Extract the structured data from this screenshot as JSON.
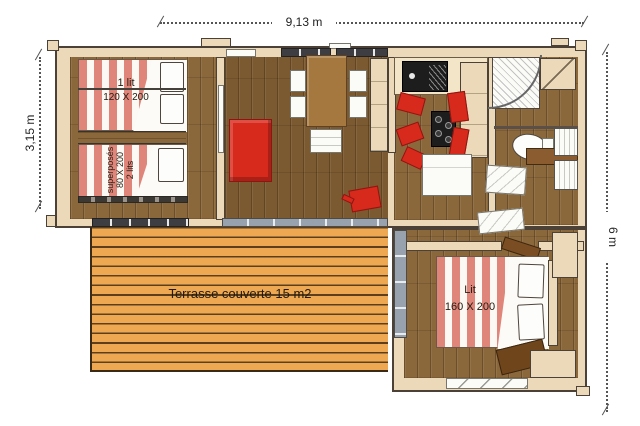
{
  "dimensions": {
    "width": "9,13 m",
    "depth_left": "3,15 m",
    "depth_right": "6 m"
  },
  "rooms": {
    "bedroom_left": {
      "single_bed": {
        "lines": [
          "1 lit",
          "120 X 200"
        ]
      },
      "bunk_bed": {
        "lines": [
          "superposés",
          "80 X 200",
          "2 lits"
        ]
      }
    },
    "bedroom_right": {
      "double_bed": {
        "lines": [
          "Lit",
          "160 X 200"
        ]
      }
    },
    "terrace": {
      "label": "Terrasse couverte 15 m2"
    }
  },
  "colors": {
    "wall": "#ecd9ba",
    "wall-outline": "#4b4137",
    "wood": "#8a683c",
    "wood-dark": "#7b5a31",
    "deck": "#eda851",
    "deck-line": "#5d3f1e",
    "accent-red": "#d8291d",
    "bed-stripe": "#e0857a",
    "glazing": "#98a2ae",
    "appliance": "#1d1d1d"
  }
}
